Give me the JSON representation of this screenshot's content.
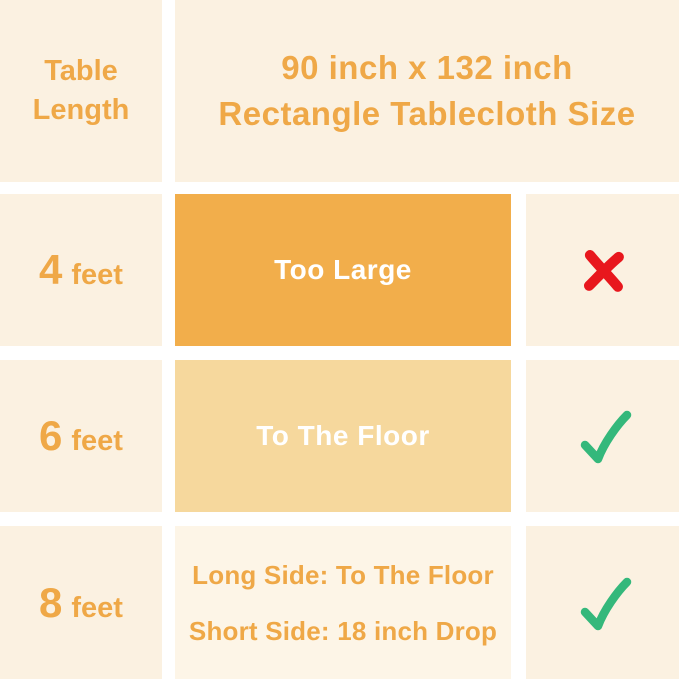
{
  "length_header": {
    "line1": "Table",
    "line2": "Length"
  },
  "title": {
    "line1": "90 inch x 132 inch",
    "line2": "Rectangle Tablecloth Size"
  },
  "rows": [
    {
      "length_value": "4",
      "length_unit": "feet",
      "fit_label": "Too Large",
      "verdict": "no"
    },
    {
      "length_value": "6",
      "length_unit": "feet",
      "fit_label": "To The Floor",
      "verdict": "yes"
    },
    {
      "length_value": "8",
      "length_unit": "feet",
      "fit_line1": "Long Side: To The Floor",
      "fit_line2": "Short Side: 18 inch Drop",
      "verdict": "yes"
    }
  ],
  "icons": {
    "no": "x-mark-icon",
    "yes": "check-mark-icon"
  },
  "colors": {
    "background_cream": "#FBF1E1",
    "divider_white": "#FFFFFF",
    "solid_fill_orange": "#F2AE4B",
    "light_fill_orange": "#F6D89D",
    "row3_fill_cream": "#FDF5E7",
    "text_orange": "#EFA847",
    "fit_text_white": "#FFFFFF",
    "x_red": "#E8171D",
    "check_green": "#34B87B"
  },
  "chart_data": {
    "type": "table",
    "title": "90 inch x 132 inch Rectangle Tablecloth Size",
    "columns": [
      "Table Length",
      "90 inch x 132 inch Rectangle Tablecloth Size",
      "Suitability"
    ],
    "rows": [
      [
        "4 feet",
        "Too Large",
        "no"
      ],
      [
        "6 feet",
        "To The Floor",
        "yes"
      ],
      [
        "8 feet",
        "Long Side: To The Floor / Short Side: 18 inch Drop",
        "yes"
      ]
    ]
  }
}
